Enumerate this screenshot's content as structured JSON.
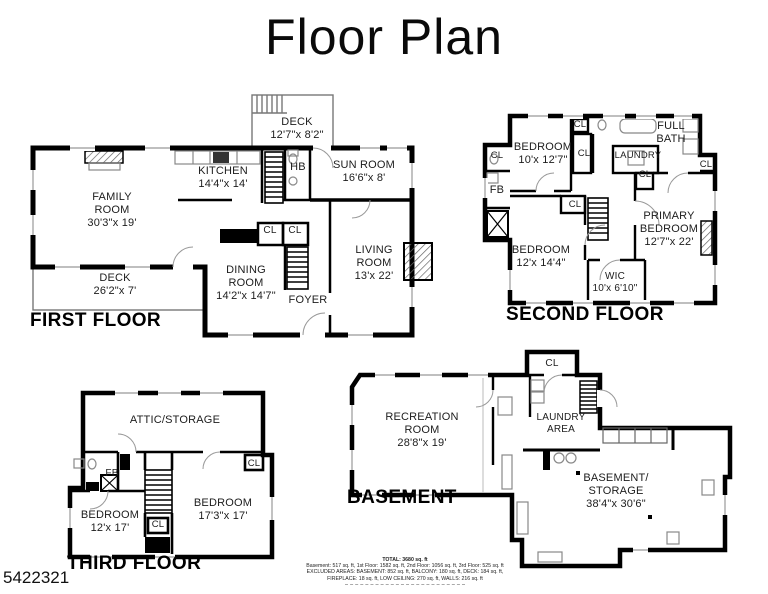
{
  "title": "Floor Plan",
  "watermark": "5422321",
  "colors": {
    "wall": "#000000",
    "deck_line": "#777777",
    "fixture_line": "#8a8a8a",
    "text": "#1c1c1c"
  },
  "floors": {
    "first": {
      "name": "FIRST FLOOR",
      "rooms": {
        "deck_upper": "DECK\n12'7\"x 8'2\"",
        "kitchen": "KITCHEN\n14'4\"x 14'",
        "half_bath": "HB",
        "sun_room": "SUN ROOM\n16'6\"x 8'",
        "family_room": "FAMILY\nROOM\n30'3\"x 19'",
        "deck_lower": "DECK\n26'2\"x 7'",
        "closet_a": "CL",
        "closet_b": "CL",
        "dining_room": "DINING\nROOM\n14'2\"x 14'7\"",
        "foyer": "FOYER",
        "living_room": "LIVING\nROOM\n13'x 22'"
      }
    },
    "second": {
      "name": "SECOND FLOOR",
      "rooms": {
        "bedroom_front": "BEDROOM\n10'x 12'7\"",
        "closet_top": "CL",
        "closet_left": "CL",
        "closet_mid": "CL",
        "full_bath": "FULL\nBATH",
        "laundry": "LAUNDRY",
        "closet_laundry": "CL",
        "closet_right": "CL",
        "fb": "FB",
        "closet_bedroom": "CL",
        "bedroom_rear": "BEDROOM\n12'x 14'4\"",
        "primary_bedroom": "PRIMARY\nBEDROOM\n12'7\"x 22'",
        "wic": "WIC\n10'x 6'10\""
      }
    },
    "third": {
      "name": "THIRD FLOOR",
      "rooms": {
        "attic": "ATTIC/STORAGE",
        "fb": "FB",
        "closet_right": "CL",
        "bedroom_left": "BEDROOM\n12'x 17'",
        "closet_center": "CL",
        "bedroom_right": "BEDROOM\n17'3\"x 17'"
      }
    },
    "basement": {
      "name": "BASEMENT",
      "rooms": {
        "closet": "CL",
        "recreation_room": "RECREATION\nROOM\n28'8\"x 19'",
        "laundry_area": "LAUNDRY\nAREA",
        "storage": "BASEMENT/\nSTORAGE\n38'4\"x 30'6\""
      }
    }
  },
  "summary": {
    "total": "TOTAL: 3680 sq. ft",
    "breakdown": "Basement: 517 sq. ft, 1st Floor: 1582 sq. ft, 2nd Floor: 1056 sq. ft, 3rd Floor: 525 sq. ft",
    "excluded1": "EXCLUDED AREAS: BASEMENT: 852 sq. ft, BALCONY: 180 sq. ft, DECK: 184 sq. ft,",
    "excluded2": "FIREPLACE: 18 sq. ft, LOW CEILING: 270 sq. ft, WALLS: 216 sq. ft"
  }
}
